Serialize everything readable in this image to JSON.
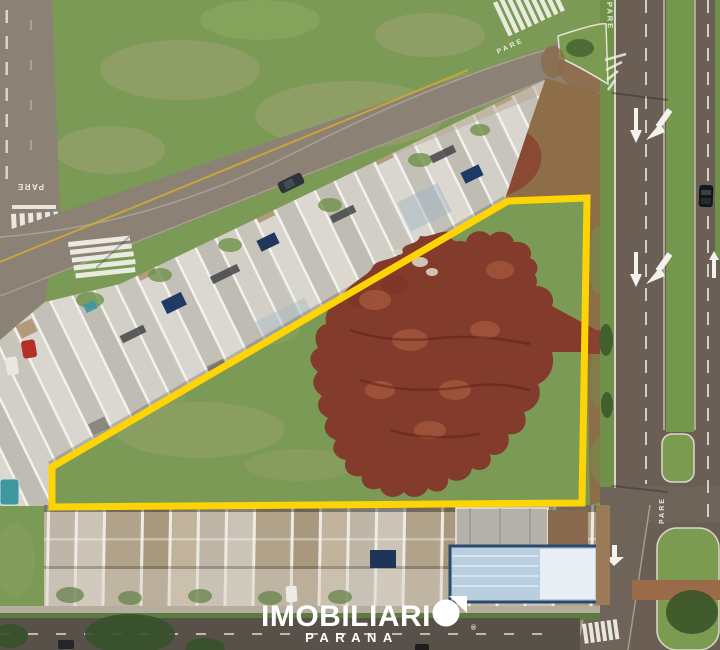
{
  "scene": {
    "type": "aerial-drone-photo",
    "subject": "Vacant corner land lot outlined in yellow, bordered by rows of townhouses, a stop-controlled street grid and a divided avenue, with red earth mounds piled on the lot"
  },
  "watermark": {
    "brand_text": "IMOBILIARI",
    "brand_icon": "circle-pennant-o-icon",
    "registered_mark": "®",
    "subtitle": "PARANA"
  },
  "road_markings": {
    "stop_text": "PARE"
  },
  "colors": {
    "lot_outline": "#FFD405",
    "grass": "#7B9A55",
    "dirt_mound": "#833B2B",
    "asphalt_street": "#8B8175",
    "asphalt_avenue": "#6B5E54",
    "logo": "#FFFFFF"
  }
}
